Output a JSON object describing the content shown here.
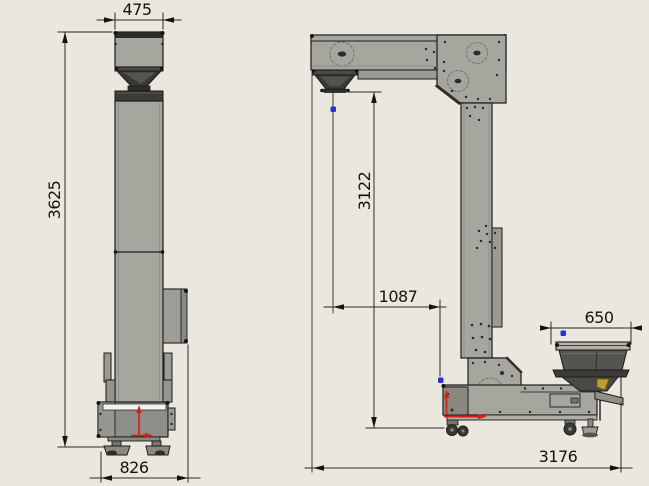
{
  "drawing": {
    "type": "z-bucket-elevator-technical-drawing",
    "colors": {
      "background": "#e9e7de",
      "body_gray": "#a6a59e",
      "dark_gray": "#3c3b37",
      "outline": "#1c1c1a",
      "dimension_ink": "#14140f",
      "accent_red": "#d42015",
      "accent_blue": "#2a2fd6"
    },
    "front_view": {
      "dimensions": {
        "top_width": "475",
        "overall_height": "3625",
        "base_width": "826"
      }
    },
    "side_view": {
      "dimensions": {
        "discharge_height": "3122",
        "discharge_offset": "1087",
        "infeed_hopper_width": "650",
        "overall_length": "3176"
      }
    }
  }
}
